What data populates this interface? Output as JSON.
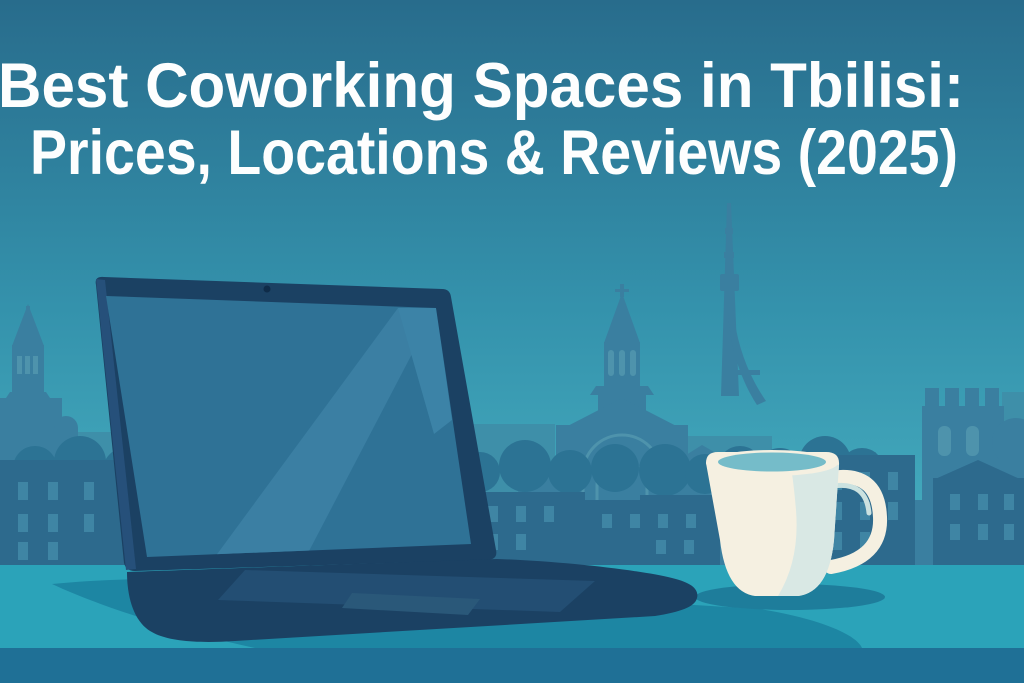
{
  "title": {
    "line1": "Best Coworking Spaces in Tbilisi:",
    "line2": "Prices, Locations & Reviews (2025)"
  },
  "scene": {
    "type": "flat vector illustration",
    "objects": [
      "open laptop",
      "white coffee mug",
      "desk"
    ],
    "skyline_landmarks": [
      "domed cathedral with cross",
      "TV broadcasting tower",
      "crenellated fortress tower",
      "old town houses",
      "small church tower"
    ]
  },
  "colors": {
    "sky_top": "#286C8C",
    "sky_mid": "#3492AC",
    "sky_horizon": "#44ABBE",
    "skyline_far": "#3E8FA9",
    "skyline_mid": "#3A7FA0",
    "skyline_near": "#2D6A8D",
    "skyline_bush": "#2C7394",
    "window_light": "#3F85A4",
    "arch_detail": "#4E93AC",
    "desk_top": "#2BA3B9",
    "desk_shadow": "#1D86A3",
    "desk_front": "#1F7096",
    "laptop_body": "#1B4163",
    "laptop_edge": "#26507A",
    "laptop_hinge": "#153A5C",
    "laptop_screen": "#2F7296",
    "screen_highlight": "#3B7FA3",
    "screen_corner": "#3C83A7",
    "keyboard_panel": "#234E73",
    "trackpad": "#2A5879",
    "webcam": "#0F2C49",
    "mug_body": "#F5F0E1",
    "mug_shade": "#D9E8E4",
    "mug_highlight": "#CBE2E0",
    "coffee_surface": "#75BCC9",
    "mug_shadow": "#1E7D9B",
    "title_text": "#FDFEFE"
  }
}
